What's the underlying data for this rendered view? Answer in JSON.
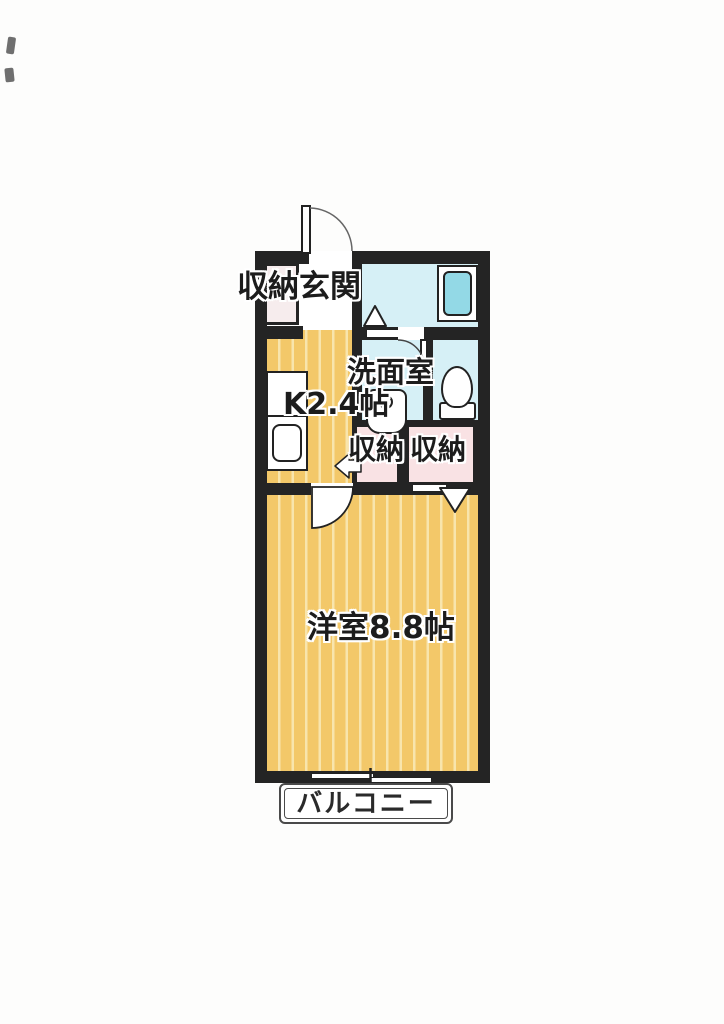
{
  "title": "1K apartment floor plan",
  "labels": {
    "entrance_closet": "収納",
    "entrance": "玄関",
    "washroom": "洗面室",
    "kitchen_size": "K2.4帖",
    "closet_left": "収納",
    "closet_right": "収納",
    "main_room_size": "洋室8.8帖",
    "balcony": "バルコニー"
  },
  "colors": {
    "wall": "#242424",
    "floor_base": "#f3c869",
    "floor_stripe": "#f8e5ad",
    "water_room": "#d6f0f6",
    "bathtub": "#93d9e6",
    "closet_pink": "#f9e2e4",
    "entrance_closet_pink": "#f6eced",
    "line": "#222222",
    "balcony_line": "#4a4a4a",
    "text": "#1c1c1c"
  },
  "fixtures": [
    "entrance-door",
    "bathtub",
    "bath-door-marker",
    "washroom-door",
    "washbasin",
    "toilet",
    "kitchen-counter",
    "kitchen-sink",
    "closet-door-marker",
    "room-door",
    "sliding-window",
    "direction-arrow"
  ]
}
